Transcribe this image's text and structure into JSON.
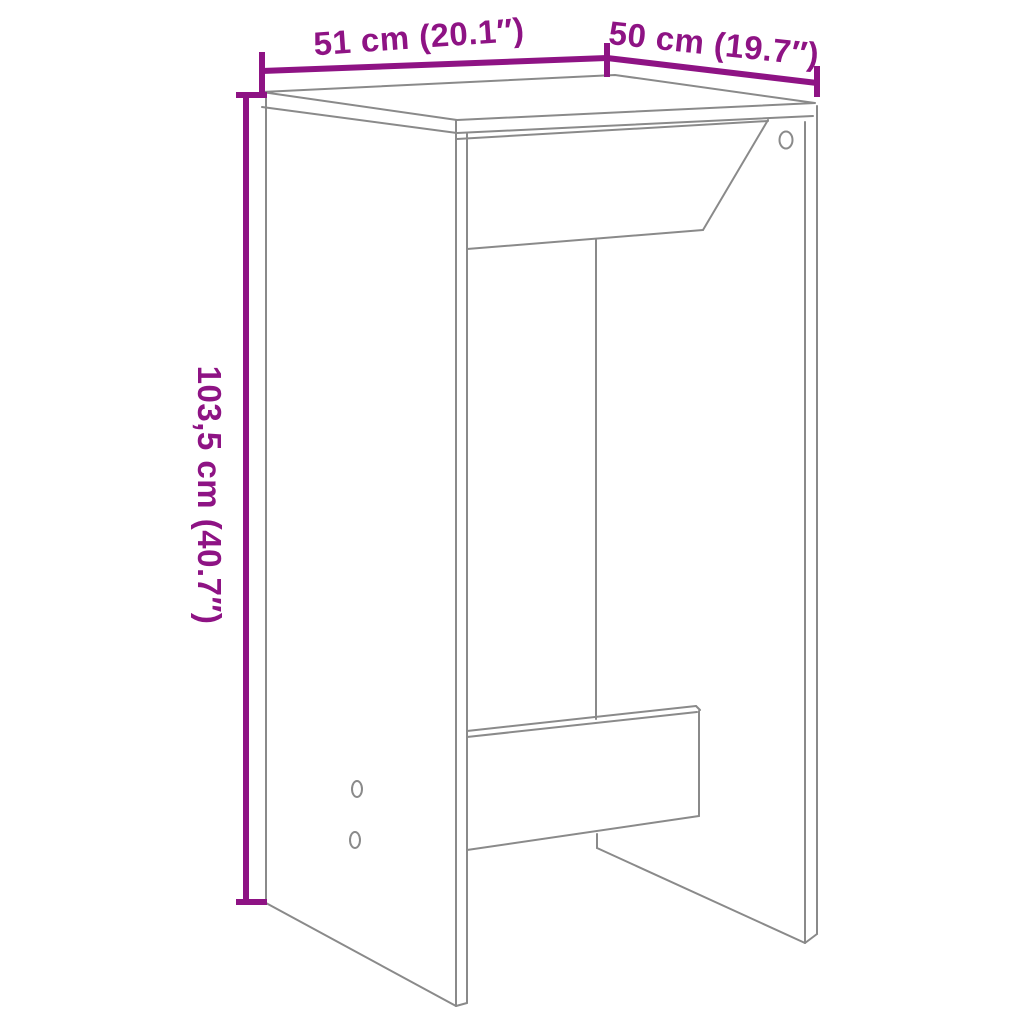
{
  "diagram": {
    "kind": "furniture-dimension-line-drawing",
    "product": "bar-table",
    "colors": {
      "dimension": "#8E1384",
      "outline": "#8A8A8A",
      "background": "#FFFFFF"
    },
    "dimensions": {
      "width": {
        "label": "51 cm (20.1″)",
        "orientation": "slanted-top-left"
      },
      "depth": {
        "label": "50 cm (19.7″)",
        "orientation": "slanted-top-right"
      },
      "height": {
        "label": "103,5 cm (40.7″)",
        "orientation": "vertical-left"
      }
    },
    "features": {
      "screw_holes_left_panel": 2,
      "screw_holes_right_panel": 1
    }
  }
}
